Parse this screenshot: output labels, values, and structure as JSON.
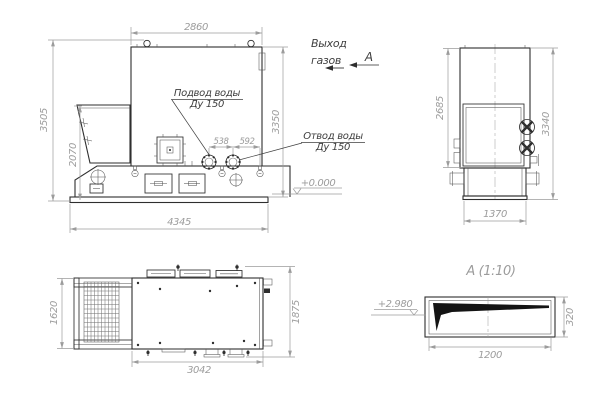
{
  "drawing": {
    "front_view": {
      "dim_width_top": "2860",
      "dim_height_total": "3505",
      "dim_hopper_height": "2070",
      "dim_height_body": "3350",
      "dim_flange_spacing_1": "538",
      "dim_flange_spacing_2": "592",
      "dim_base_width": "4345",
      "level_zero": "+0.000",
      "label_inlet_line1": "Подвод воды",
      "label_inlet_line2": "Ду 150",
      "label_outlet_line1": "Отвод воды",
      "label_outlet_line2": "Ду 150"
    },
    "gas_outlet_note": {
      "line1": "Выход",
      "line2": "газов"
    },
    "section_marker": "А",
    "side_view": {
      "dim_height_door": "2685",
      "dim_height_total": "3340",
      "dim_width_bottom": "1370"
    },
    "plan_view": {
      "dim_depth_left": "1620",
      "dim_depth_right": "1875",
      "dim_width_bottom": "3042"
    },
    "detail_a": {
      "title": "А (1:10)",
      "level_mark": "+2.980",
      "dim_height": "320",
      "dim_width": "1200"
    }
  },
  "colors": {
    "outline": "#2e2e2e",
    "thin": "#555555",
    "dimension": "#9c9c9c",
    "label": "#3f3f3f",
    "background": "#ffffff"
  }
}
